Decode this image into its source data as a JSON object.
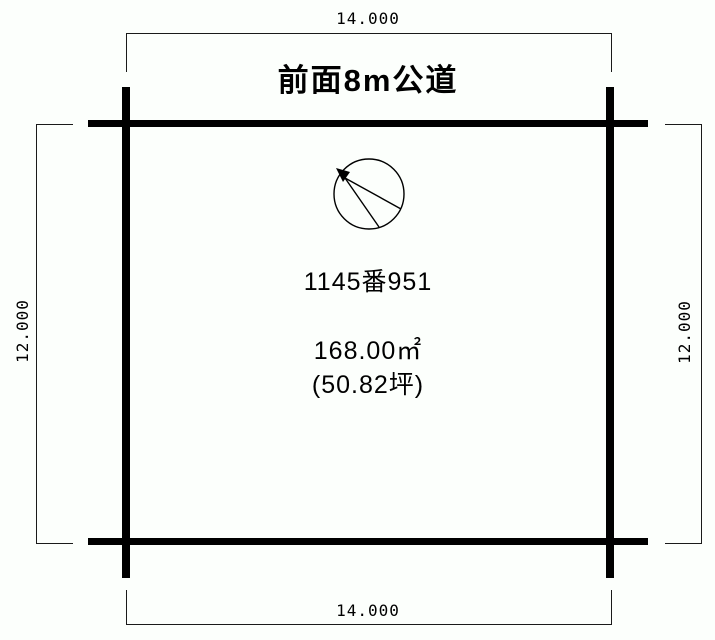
{
  "canvas": {
    "background_color": "#fcfffc",
    "line_color": "#000000"
  },
  "road_label": "前面8m公道",
  "dimensions": {
    "top": "14.000",
    "bottom": "14.000",
    "left": "12.000",
    "right": "12.000"
  },
  "parcel": {
    "lot_number": "1145番951",
    "area_sqm": "168.00㎡",
    "area_tsubo": "(50.82坪)"
  },
  "icons": {
    "compass": "north-direction-indicator"
  }
}
